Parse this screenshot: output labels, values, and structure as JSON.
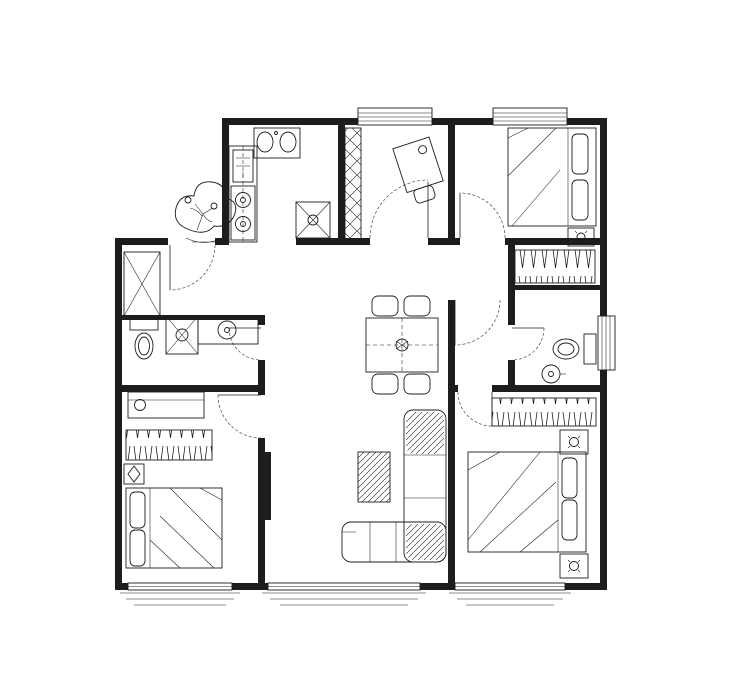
{
  "meta": {
    "drawing_type": "residential-floor-plan",
    "units": "mm"
  },
  "colors": {
    "wall": "#1d1d1d",
    "line": "#1d1d1d",
    "dim_text": "#111111",
    "background": "#ffffff"
  },
  "chains": [
    {
      "name": "dim-top-total",
      "orient": "h",
      "line": 74,
      "ticks": [
        115,
        607
      ],
      "labels": [
        "12320"
      ]
    },
    {
      "name": "dim-top-chain",
      "orient": "h",
      "line": 87,
      "ticks": [
        115,
        167,
        210,
        280,
        317,
        343,
        443,
        506,
        574,
        607
      ],
      "labels": [
        "1300",
        "1080",
        "1750",
        "930",
        "650",
        "2500",
        "1580",
        "1700",
        "830"
      ]
    },
    {
      "name": "dim-bottom-chain",
      "orient": "h",
      "line": 603,
      "ticks": [
        115,
        152,
        230,
        297,
        407,
        473,
        550,
        593
      ],
      "labels": [
        "930",
        "1950",
        "1680",
        "2750",
        "1650",
        "1930",
        "1080"
      ]
    },
    {
      "name": "dim-bottom-total",
      "orient": "h",
      "line": 622,
      "ticks": [
        115,
        593
      ],
      "labels": [
        "11970"
      ]
    },
    {
      "name": "dim-left-total",
      "orient": "v",
      "line": 78,
      "ticks": [
        115,
        593
      ],
      "labels": [
        "11960"
      ]
    },
    {
      "name": "dim-left-chain",
      "orient": "v",
      "line": 97,
      "ticks": [
        115,
        240,
        593
      ],
      "labels": [
        "3130",
        "8830"
      ]
    },
    {
      "name": "dim-right-chain",
      "orient": "v",
      "line": 630,
      "ticks": [
        115,
        325,
        365,
        593
      ],
      "labels": [
        "5250",
        "1000",
        "5700"
      ]
    },
    {
      "name": "dim-right-total",
      "orient": "v",
      "line": 648,
      "ticks": [
        115,
        593
      ],
      "labels": [
        "11950"
      ]
    }
  ],
  "interior_labels": [
    {
      "x": 277,
      "y": 165,
      "t": "900"
    },
    {
      "x": 263,
      "y": 196,
      "r": -90,
      "t": "2550"
    },
    {
      "x": 309,
      "y": 197,
      "t": "600"
    },
    {
      "x": 395,
      "y": 140,
      "t": "2150"
    },
    {
      "x": 369,
      "y": 187,
      "r": -90,
      "t": "2750"
    },
    {
      "x": 424,
      "y": 233,
      "t": "500"
    },
    {
      "x": 549,
      "y": 171,
      "t": "2650"
    },
    {
      "x": 528,
      "y": 181,
      "r": -90,
      "t": "1800"
    },
    {
      "x": 551,
      "y": 247,
      "t": "1870"
    },
    {
      "x": 512,
      "y": 267,
      "r": -90,
      "t": "600"
    },
    {
      "x": 552,
      "y": 304,
      "t": "1800"
    },
    {
      "x": 521,
      "y": 376,
      "r": -90,
      "t": "580"
    },
    {
      "x": 142,
      "y": 249,
      "t": "900"
    },
    {
      "x": 167,
      "y": 286,
      "r": -90,
      "t": "350"
    },
    {
      "x": 182,
      "y": 362,
      "t": "700"
    },
    {
      "x": 166,
      "y": 424,
      "t": "1500"
    },
    {
      "x": 205,
      "y": 527,
      "r": -90,
      "t": "1500"
    },
    {
      "x": 188,
      "y": 561,
      "t": "2120"
    },
    {
      "x": 289,
      "y": 488,
      "r": -90,
      "t": "1730"
    },
    {
      "x": 374,
      "y": 449,
      "t": "800"
    },
    {
      "x": 399,
      "y": 478,
      "r": -90,
      "t": "950"
    },
    {
      "x": 350,
      "y": 572,
      "t": "750"
    },
    {
      "x": 357,
      "y": 346,
      "r": -90,
      "t": "850"
    },
    {
      "x": 546,
      "y": 434,
      "t": "2450"
    },
    {
      "x": 513,
      "y": 445,
      "r": -90,
      "t": "400"
    },
    {
      "x": 548,
      "y": 477,
      "t": "2000"
    },
    {
      "x": 519,
      "y": 502,
      "r": -90,
      "t": "1800"
    },
    {
      "x": 527,
      "y": 557,
      "t": "2400"
    }
  ]
}
